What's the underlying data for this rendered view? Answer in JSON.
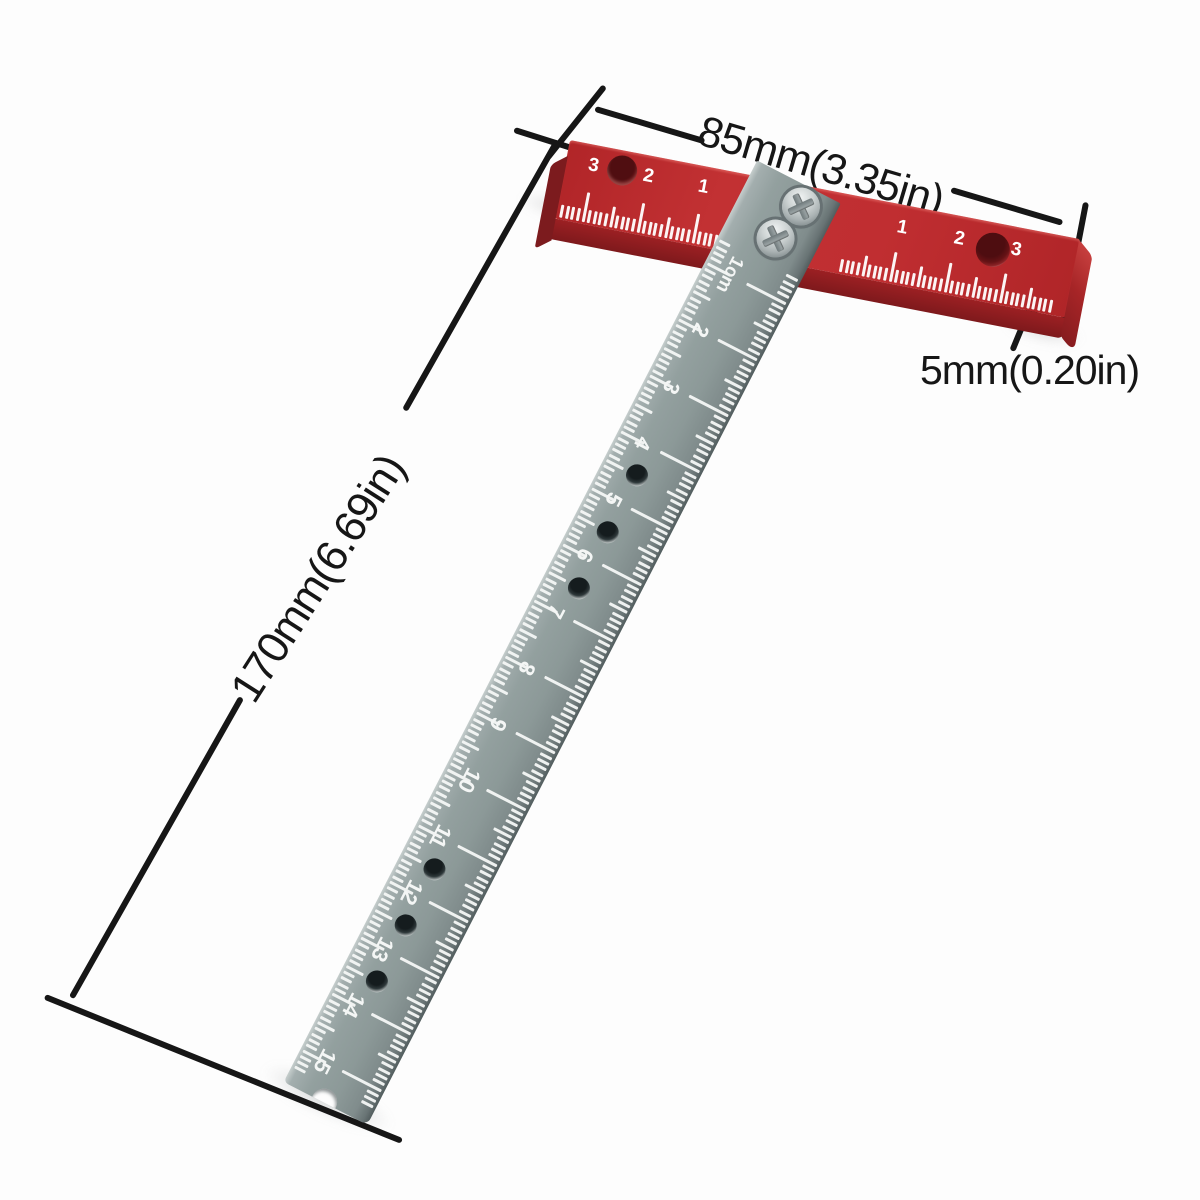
{
  "background_color": "#fdfdfd",
  "annotation": {
    "color": "#161616",
    "width_label": "85mm(3.35in)",
    "thickness_label": "5mm(0.20in)",
    "length_label": "170mm(6.69in)"
  },
  "crossbar": {
    "body_color": "#bd2b2e",
    "marking_color": "#ffffff",
    "left_scale_numbers": [
      "1",
      "2",
      "3"
    ],
    "right_scale_numbers": [
      "1",
      "2",
      "3"
    ]
  },
  "blade": {
    "body_color": "#8e999b",
    "marking_color": "#f4f6f5",
    "scale_labels": [
      "1cm",
      "2",
      "3",
      "4",
      "5",
      "6",
      "7",
      "8",
      "9",
      "10",
      "11",
      "12",
      "13",
      "14",
      "15"
    ]
  }
}
